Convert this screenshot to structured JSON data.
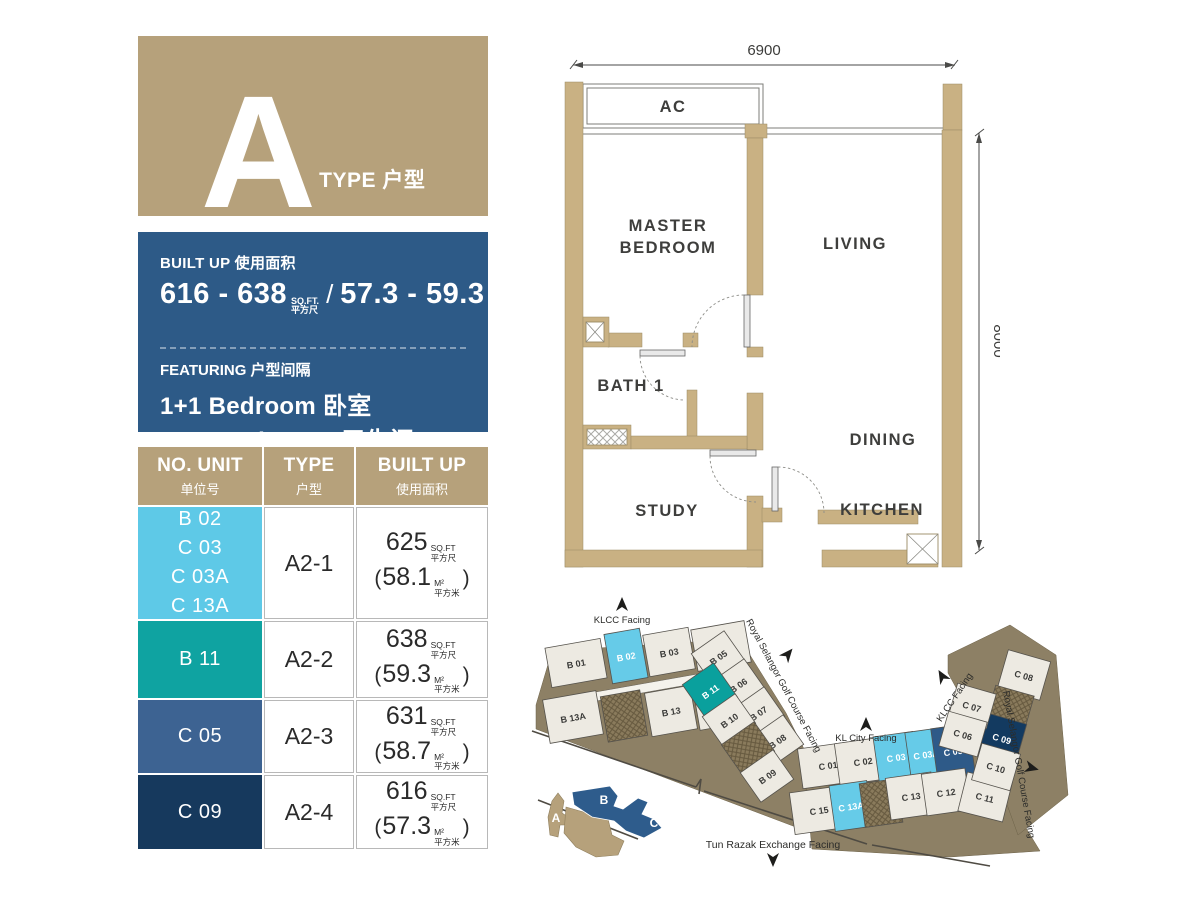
{
  "palette": {
    "tan": "#b6a17b",
    "panel_blue": "#2d5a87",
    "wall_tan": "#c9b183",
    "ground_brown": "#8d8065",
    "light_blue": "#5ec9e7",
    "teal": "#0fa3a1",
    "steel_blue": "#3d6392",
    "navy": "#16395d"
  },
  "type_card": {
    "letter": "A",
    "suffix": "TYPE 户型"
  },
  "info_box": {
    "built_up_label": "BUILT UP 使用面积",
    "sqft_value": "616 - 638",
    "sqft_unit": "SQ.FT.",
    "sqft_unit_cn": "平方尺",
    "slash": "/",
    "sqm_value": "57.3 - 59.3",
    "sqm_unit": "M²",
    "sqm_unit_cn": "平方米",
    "featuring_label": "FEATURING 户型间隔",
    "feature_line1": "1+1 Bedroom 卧室",
    "feature_line2": "1 Bathroom 卫生间"
  },
  "table": {
    "headers": [
      {
        "en": "NO. UNIT",
        "cn": "单位号"
      },
      {
        "en": "TYPE",
        "cn": "户型"
      },
      {
        "en": "BUILT UP",
        "cn": "使用面积"
      }
    ],
    "sqft_unit": "SQ.FT",
    "sqft_unit_cn": "平方尺",
    "sqm_unit": "M²",
    "sqm_unit_cn": "平方米",
    "open_paren": "(",
    "close_paren": ")",
    "rows": [
      {
        "units": [
          "B 02",
          "C 03",
          "C 03A",
          "C 13A"
        ],
        "swatch": "#5ec9e7",
        "type": "A2-1",
        "sqft": "625",
        "sqm": "58.1"
      },
      {
        "units": [
          "B 11"
        ],
        "swatch": "#0fa3a1",
        "type": "A2-2",
        "sqft": "638",
        "sqm": "59.3"
      },
      {
        "units": [
          "C 05"
        ],
        "swatch": "#3d6392",
        "type": "A2-3",
        "sqft": "631",
        "sqm": "58.7"
      },
      {
        "units": [
          "C 09"
        ],
        "swatch": "#16395d",
        "type": "A2-4",
        "sqft": "616",
        "sqm": "57.3"
      }
    ]
  },
  "floor_plan": {
    "dim_top": "6900",
    "dim_right": "8000",
    "rooms": {
      "ac": "AC",
      "master1": "MASTER",
      "master2": "BEDROOM",
      "living": "LIVING",
      "bath": "BATH 1",
      "dining": "DINING",
      "study": "STUDY",
      "kitchen": "KITCHEN"
    }
  },
  "site_plan": {
    "facing_klcc_b": "KLCC Facing",
    "facing_golf_b": "Royal Selangor Golf Course Facing",
    "facing_klcity": "KL City Facing",
    "facing_klcc_c": "KLCC Facing",
    "facing_golf_c": "Royal Selangor Golf Course Facing",
    "facing_trx": "Tun Razak Exchange Facing",
    "b_units": [
      {
        "label": "B 01",
        "fill": "#edeae2",
        "tc": "#3a3a38"
      },
      {
        "label": "B 02",
        "fill": "#66cbe8",
        "tc": "#ffffff"
      },
      {
        "label": "B 03",
        "fill": "#edeae2",
        "tc": "#3a3a38"
      },
      {
        "label": "B 03A",
        "fill": "#edeae2",
        "tc": "#3a3a38"
      },
      {
        "label": "B 13A",
        "fill": "#edeae2",
        "tc": "#3a3a38"
      },
      {
        "label": "B 13",
        "fill": "#edeae2",
        "tc": "#3a3a38"
      },
      {
        "label": "B 12",
        "fill": "#edeae2",
        "tc": "#3a3a38"
      },
      {
        "label": "B 05",
        "fill": "#edeae2",
        "tc": "#3a3a38"
      },
      {
        "label": "B 06",
        "fill": "#edeae2",
        "tc": "#3a3a38"
      },
      {
        "label": "B 07",
        "fill": "#edeae2",
        "tc": "#3a3a38"
      },
      {
        "label": "B 08",
        "fill": "#edeae2",
        "tc": "#3a3a38"
      },
      {
        "label": "B 09",
        "fill": "#edeae2",
        "tc": "#3a3a38"
      },
      {
        "label": "B 11",
        "fill": "#0aa09d",
        "tc": "#ffffff"
      },
      {
        "label": "B 10",
        "fill": "#edeae2",
        "tc": "#3a3a38"
      }
    ],
    "c_units": [
      {
        "label": "C 01",
        "fill": "#edeae2",
        "tc": "#3a3a38"
      },
      {
        "label": "C 02",
        "fill": "#edeae2",
        "tc": "#3a3a38"
      },
      {
        "label": "C 03",
        "fill": "#66cbe8",
        "tc": "#ffffff"
      },
      {
        "label": "C 03A",
        "fill": "#66cbe8",
        "tc": "#ffffff"
      },
      {
        "label": "C 05",
        "fill": "#2e5a88",
        "tc": "#ffffff"
      },
      {
        "label": "C 15",
        "fill": "#edeae2",
        "tc": "#3a3a38"
      },
      {
        "label": "C 13A",
        "fill": "#66cbe8",
        "tc": "#ffffff"
      },
      {
        "label": "C 13",
        "fill": "#edeae2",
        "tc": "#3a3a38"
      },
      {
        "label": "C 12",
        "fill": "#edeae2",
        "tc": "#3a3a38"
      },
      {
        "label": "C 11",
        "fill": "#edeae2",
        "tc": "#3a3a38"
      },
      {
        "label": "C 08",
        "fill": "#edeae2",
        "tc": "#3a3a38"
      },
      {
        "label": "C 07",
        "fill": "#edeae2",
        "tc": "#3a3a38"
      },
      {
        "label": "C 06",
        "fill": "#edeae2",
        "tc": "#3a3a38"
      },
      {
        "label": "C 09",
        "fill": "#133a60",
        "tc": "#ffffff"
      },
      {
        "label": "C 10",
        "fill": "#edeae2",
        "tc": "#3a3a38"
      }
    ],
    "key_blocks": {
      "a": "A",
      "b": "B",
      "c": "C"
    }
  }
}
